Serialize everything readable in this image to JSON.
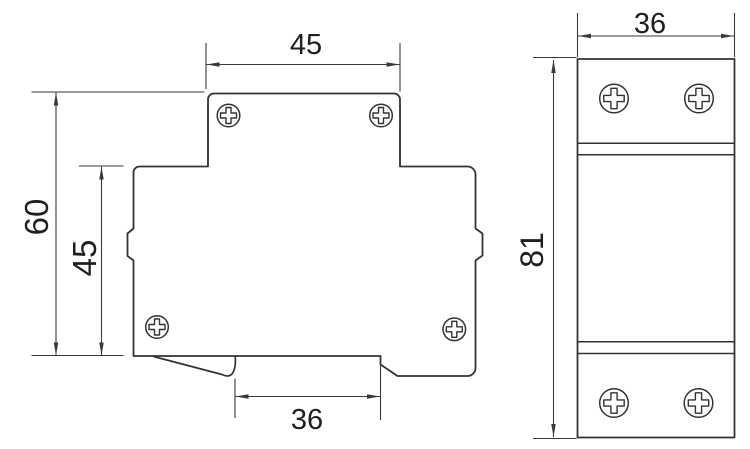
{
  "drawing": {
    "type": "technical-dimension-drawing",
    "subject": "din-rail-device-two-views",
    "side_view": {
      "labels": {
        "top_width": "45",
        "overall_height": "60",
        "body_height": "45",
        "bottom_width": "36"
      }
    },
    "front_view": {
      "labels": {
        "width": "36",
        "height": "81"
      }
    }
  },
  "icons": {
    "screw": "phillips-screw-icon (circle with outlined cross)"
  },
  "colors": {
    "outline": "#333333",
    "dimension": "#3a3a3a",
    "label": "#1f1f1f",
    "background": "#ffffff"
  }
}
